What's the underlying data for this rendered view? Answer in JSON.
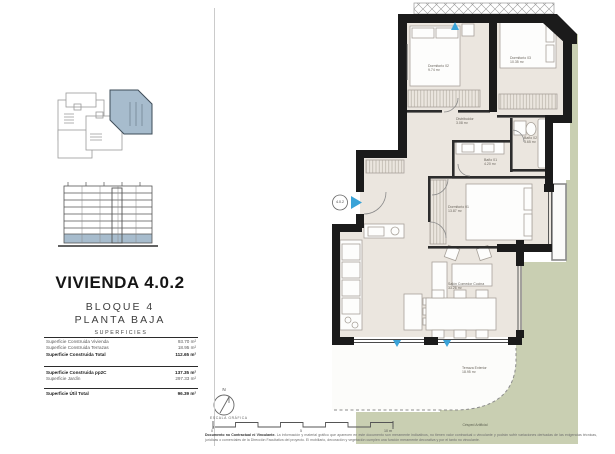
{
  "left_panel": {
    "title": "VIVIENDA 4.0.2",
    "block": "BLOQUE 4",
    "floor": "PLANTA BAJA",
    "table": {
      "header": "SUPERFICIES",
      "rows": [
        {
          "label": "Superficie Construida Vivienda",
          "value": "93.70 m²"
        },
        {
          "label": "Superficie Construida Terrazas",
          "value": "18.95 m²"
        },
        {
          "label": "Superficie Construida Total",
          "value": "112.65 m²"
        },
        {
          "label": "Superficie Construida pp2C",
          "value": "137.35 m²"
        },
        {
          "label": "Superficie Jardín",
          "value": "297.33 m²"
        },
        {
          "label": "Superficie Útil Total",
          "value": "96.39 m²"
        }
      ]
    }
  },
  "plan": {
    "unit_badge": "4.0.2",
    "rooms": {
      "d02": {
        "name": "Dormitorio 02",
        "area": "9.74 m²"
      },
      "d03": {
        "name": "Dormitorio 03",
        "area": "10.35 m²"
      },
      "dist": {
        "name": "Distribuidor",
        "area": "3.08 m²"
      },
      "b02": {
        "name": "Baño 02",
        "area": "3.65 m²"
      },
      "b01": {
        "name": "Baño 01",
        "area": "4.20 m²"
      },
      "d01": {
        "name": "Dormitorio 01",
        "area": "13.87 m²"
      },
      "salon": {
        "name": "Salón Comedor Cocina",
        "area": "33.26 m²"
      },
      "terraza": {
        "name": "Terraza Exterior",
        "area": "18.95 m²"
      }
    },
    "garden_label": "Césped Artificial",
    "north_label": "N",
    "scale": {
      "label": "ESCALA GRÁFICA",
      "tick0": "0",
      "tick5": "5",
      "tick10": "10 m"
    }
  },
  "footer": {
    "disclaimer_title": "Documento no Contractual ni Vinculante.",
    "disclaimer_text": "La información y material gráfico que aparecen en este documento son meramente indicativos, no tienen valor contractual o vinculante y podrán sufrir variaciones derivadas de las exigencias técnicas, jurídicas o comerciales de la Dirección Facultativa del proyecto. El mobiliario, decoración y vegetación cumplen una función meramente decorativa y por el tanto no vinculante."
  },
  "colors": {
    "accent_blue": "#a7bccd",
    "arrow_blue": "#3aa3d8",
    "garden_green": "#c9cfb2",
    "floor_beige": "#ebe6df",
    "wall_black": "#1b1b1b"
  }
}
